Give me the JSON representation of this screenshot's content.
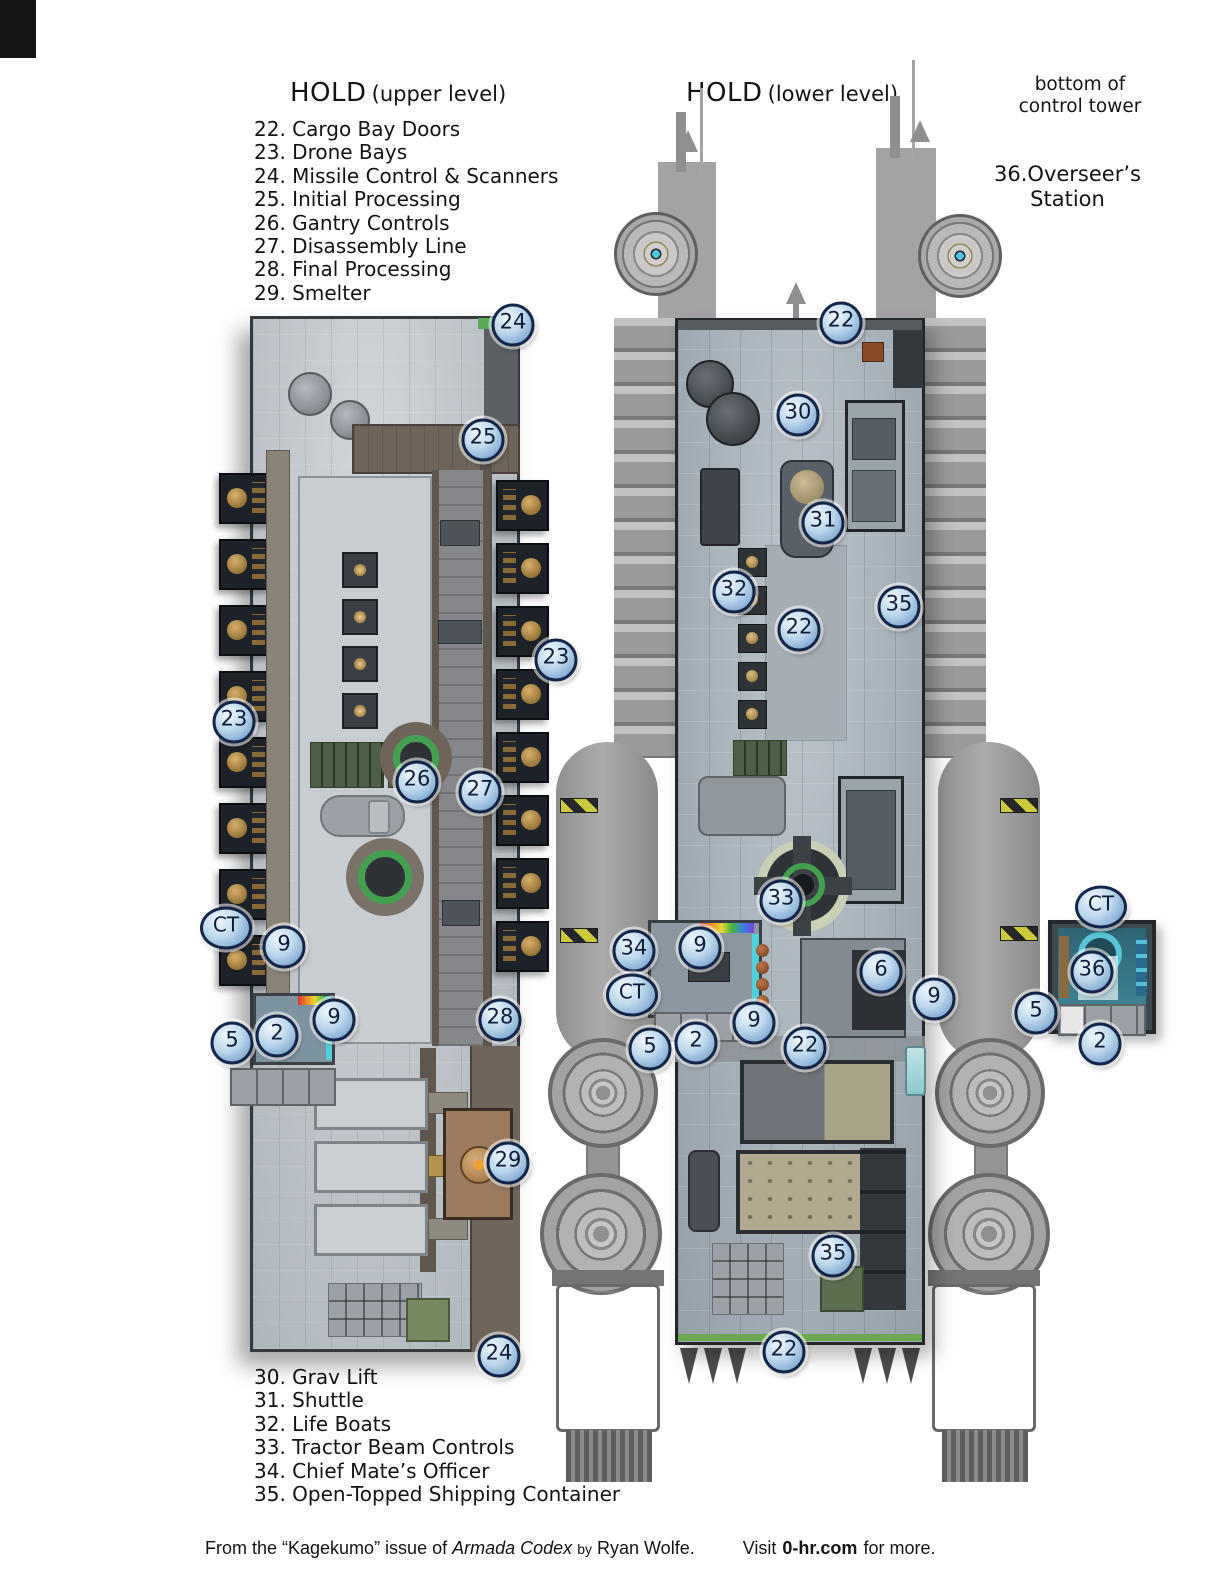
{
  "upper_map": {
    "title": "HOLD",
    "subtitle": "(upper level)",
    "legend": [
      "22. Cargo Bay Doors",
      "23. Drone Bays",
      "24. Missile Control & Scanners",
      "25. Initial Processing",
      "26. Gantry Controls",
      "27. Disassembly Line",
      "28. Final Processing",
      "29. Smelter"
    ]
  },
  "lower_map": {
    "title": "HOLD",
    "subtitle": "(lower level)",
    "legend": [
      "30. Grav Lift",
      "31. Shuttle",
      "32. Life Boats",
      "33. Tractor Beam Controls",
      "34. Chief Mate’s Officer",
      "35. Open-Topped Shipping Container"
    ]
  },
  "control_tower": {
    "caption": [
      "bottom of",
      "control tower"
    ],
    "station_label": [
      "36.Overseer’s",
      "Station"
    ]
  },
  "footer": {
    "prefix": "From the “Kagekumo” issue of ",
    "title_italic": "Armada Codex",
    "byword": "by",
    "author": "Ryan Wolfe.",
    "visit": "Visit",
    "site": "0-hr.com",
    "suffix": "for more."
  },
  "colors": {
    "badge_fill": "#bcd8ec",
    "badge_ring": "#14254a",
    "upper_floor": "#c4cacf",
    "lower_floor": "#b0bac2",
    "walkway_brown": "#6f6459",
    "accent_green": "#44a050",
    "hazard_yellow": "#caca3c",
    "cyan_glow": "#4fd0da",
    "smelter_copper": "#9b7a5e"
  },
  "badges": {
    "upper": [
      {
        "label": "24",
        "x": 513,
        "y": 325
      },
      {
        "label": "25",
        "x": 483,
        "y": 440
      },
      {
        "label": "23",
        "x": 556,
        "y": 660
      },
      {
        "label": "23",
        "x": 234,
        "y": 722
      },
      {
        "label": "26",
        "x": 417,
        "y": 782
      },
      {
        "label": "27",
        "x": 480,
        "y": 792
      },
      {
        "label": "CT",
        "x": 226,
        "y": 928
      },
      {
        "label": "9",
        "x": 284,
        "y": 947
      },
      {
        "label": "5",
        "x": 232,
        "y": 1043
      },
      {
        "label": "2",
        "x": 277,
        "y": 1036
      },
      {
        "label": "9",
        "x": 334,
        "y": 1020
      },
      {
        "label": "28",
        "x": 500,
        "y": 1020
      },
      {
        "label": "29",
        "x": 508,
        "y": 1163
      },
      {
        "label": "24",
        "x": 499,
        "y": 1356
      }
    ],
    "lower": [
      {
        "label": "22",
        "x": 841,
        "y": 323
      },
      {
        "label": "30",
        "x": 798,
        "y": 415
      },
      {
        "label": "31",
        "x": 823,
        "y": 523
      },
      {
        "label": "32",
        "x": 734,
        "y": 592
      },
      {
        "label": "22",
        "x": 799,
        "y": 630
      },
      {
        "label": "35",
        "x": 899,
        "y": 607
      },
      {
        "label": "33",
        "x": 781,
        "y": 901
      },
      {
        "label": "34",
        "x": 634,
        "y": 951
      },
      {
        "label": "9",
        "x": 700,
        "y": 948
      },
      {
        "label": "CT",
        "x": 632,
        "y": 995
      },
      {
        "label": "6",
        "x": 881,
        "y": 972
      },
      {
        "label": "9",
        "x": 934,
        "y": 999
      },
      {
        "label": "5",
        "x": 650,
        "y": 1049
      },
      {
        "label": "2",
        "x": 696,
        "y": 1043
      },
      {
        "label": "9",
        "x": 754,
        "y": 1023
      },
      {
        "label": "22",
        "x": 805,
        "y": 1048
      },
      {
        "label": "35",
        "x": 833,
        "y": 1256
      },
      {
        "label": "22",
        "x": 784,
        "y": 1352
      }
    ],
    "tower": [
      {
        "label": "CT",
        "x": 1101,
        "y": 907
      },
      {
        "label": "36",
        "x": 1092,
        "y": 972
      },
      {
        "label": "5",
        "x": 1036,
        "y": 1013
      },
      {
        "label": "2",
        "x": 1100,
        "y": 1044
      }
    ]
  }
}
